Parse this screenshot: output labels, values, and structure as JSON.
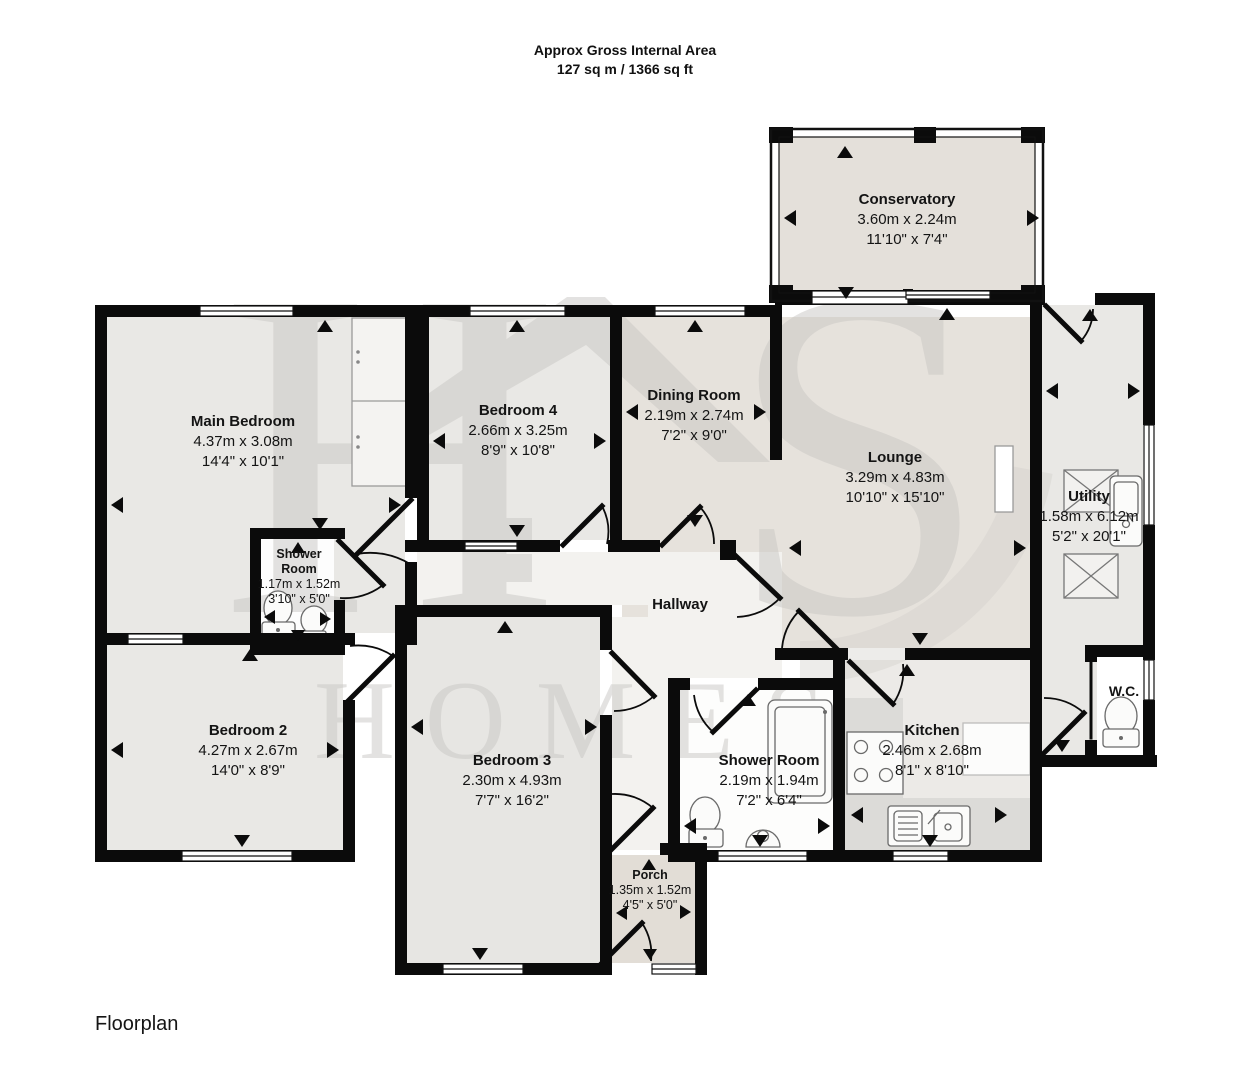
{
  "header": {
    "line1": "Approx Gross Internal Area",
    "line2": "127 sq m / 1366 sq ft"
  },
  "footer": {
    "caption": "Floorplan"
  },
  "watermark": {
    "letter1": "H",
    "letter2": "S",
    "word": "HOMES"
  },
  "rooms": {
    "conservatory": {
      "name": "Conservatory",
      "metric": "3.60m x 2.24m",
      "imperial": "11'10\" x 7'4\""
    },
    "main_bedroom": {
      "name": "Main Bedroom",
      "metric": "4.37m x 3.08m",
      "imperial": "14'4\" x 10'1\""
    },
    "bedroom4": {
      "name": "Bedroom 4",
      "metric": "2.66m x 3.25m",
      "imperial": "8'9\" x 10'8\""
    },
    "dining": {
      "name": "Dining Room",
      "metric": "2.19m x 2.74m",
      "imperial": "7'2\" x 9'0\""
    },
    "lounge": {
      "name": "Lounge",
      "metric": "3.29m x 4.83m",
      "imperial": "10'10\" x 15'10\""
    },
    "utility": {
      "name": "Utility",
      "metric": "1.58m x 6.12m",
      "imperial": "5'2\" x 20'1\""
    },
    "shower1": {
      "name": "Shower Room",
      "metric": "1.17m x 1.52m",
      "imperial": "3'10\" x 5'0\""
    },
    "hallway": {
      "name": "Hallway"
    },
    "bedroom2": {
      "name": "Bedroom 2",
      "metric": "4.27m x 2.67m",
      "imperial": "14'0\" x 8'9\""
    },
    "bedroom3": {
      "name": "Bedroom 3",
      "metric": "2.30m x 4.93m",
      "imperial": "7'7\" x 16'2\""
    },
    "shower2": {
      "name": "Shower Room",
      "metric": "2.19m x 1.94m",
      "imperial": "7'2\" x 6'4\""
    },
    "kitchen": {
      "name": "Kitchen",
      "metric": "2.46m x 2.68m",
      "imperial": "8'1\" x 8'10\""
    },
    "wc": {
      "name": "W.C."
    },
    "porch": {
      "name": "Porch",
      "metric": "1.35m x 1.52m",
      "imperial": "4'5\" x 5'0\""
    }
  },
  "colors": {
    "wall": "#0b0b0b",
    "floor_warm": "#e6e2dc",
    "floor_cool": "#e9e8e5",
    "hallway_floor": "#f3f2ef",
    "watermark_gray": "#c9c7c4"
  }
}
